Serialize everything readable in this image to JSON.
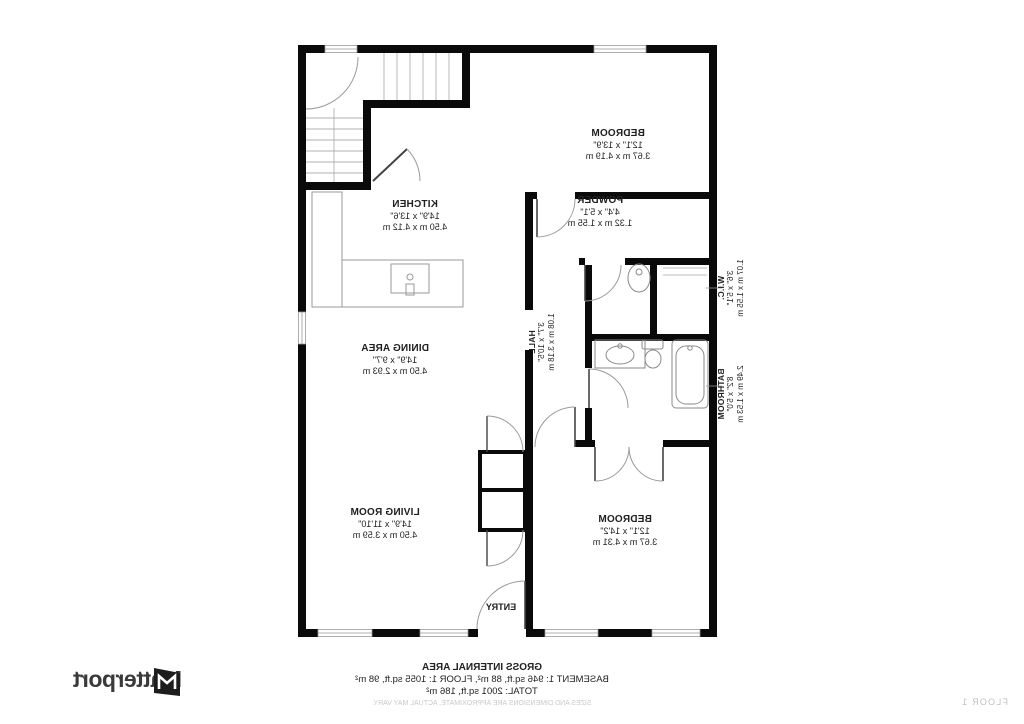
{
  "rooms": {
    "bedroom_top": {
      "name": "BEDROOM",
      "dims_ft": "12'1\" x 13'9\"",
      "dims_m": "3.67 m x 4.19 m"
    },
    "powder": {
      "name": "POWDER",
      "dims_ft": "4'4\" x 5'1\"",
      "dims_m": "1.32 m x 1.55 m"
    },
    "kitchen": {
      "name": "KITCHEN",
      "dims_ft": "14'9\" x 13'6\"",
      "dims_m": "4.50 m x 4.12 m"
    },
    "hall": {
      "name": "HALL",
      "dims_ft": "3'7\" x 10'5\"",
      "dims_m": "1.08 m x 3.18 m"
    },
    "wic": {
      "name": "W.I.C.",
      "dims_ft": "3'6\" x 5'1\"",
      "dims_m": "1.07 m x 1.55 m"
    },
    "bathroom": {
      "name": "BATHROOM",
      "dims_ft": "8'2\" x 5'0\"",
      "dims_m": "2.49 m x 1.53 m"
    },
    "dining": {
      "name": "DINING AREA",
      "dims_ft": "14'9\" x 9'7\"",
      "dims_m": "4.50 m x 2.93 m"
    },
    "living": {
      "name": "LIVING ROOM",
      "dims_ft": "14'9\" x 11'10\"",
      "dims_m": "4.50 m x 3.59 m"
    },
    "bedroom_bottom": {
      "name": "BEDROOM",
      "dims_ft": "12'1\" x 14'2\"",
      "dims_m": "3.67 m x 4.31 m"
    },
    "entry": {
      "name": "ENTRY"
    }
  },
  "footer": {
    "gross_title": "GROSS INTERNAL AREA",
    "line1": "BASEMENT 1: 946 sq.ft, 88 m², FLOOR 1: 1055 sq.ft, 98 m²",
    "line2": "TOTAL: 2001 sq.ft, 186 m²",
    "disclaimer": "SIZES AND DIMENSIONS ARE APPROXIMATE, ACTUAL MAY VARY.",
    "floor_label": "FLOOR 1"
  },
  "brand": {
    "logo_text": "Matterport"
  },
  "colors": {
    "wall": "#0a0a0a",
    "thin_line": "#9a9a9a",
    "label": "#1f1f1f",
    "muted": "#c9c9c9",
    "logo": "#3a3a3a"
  }
}
